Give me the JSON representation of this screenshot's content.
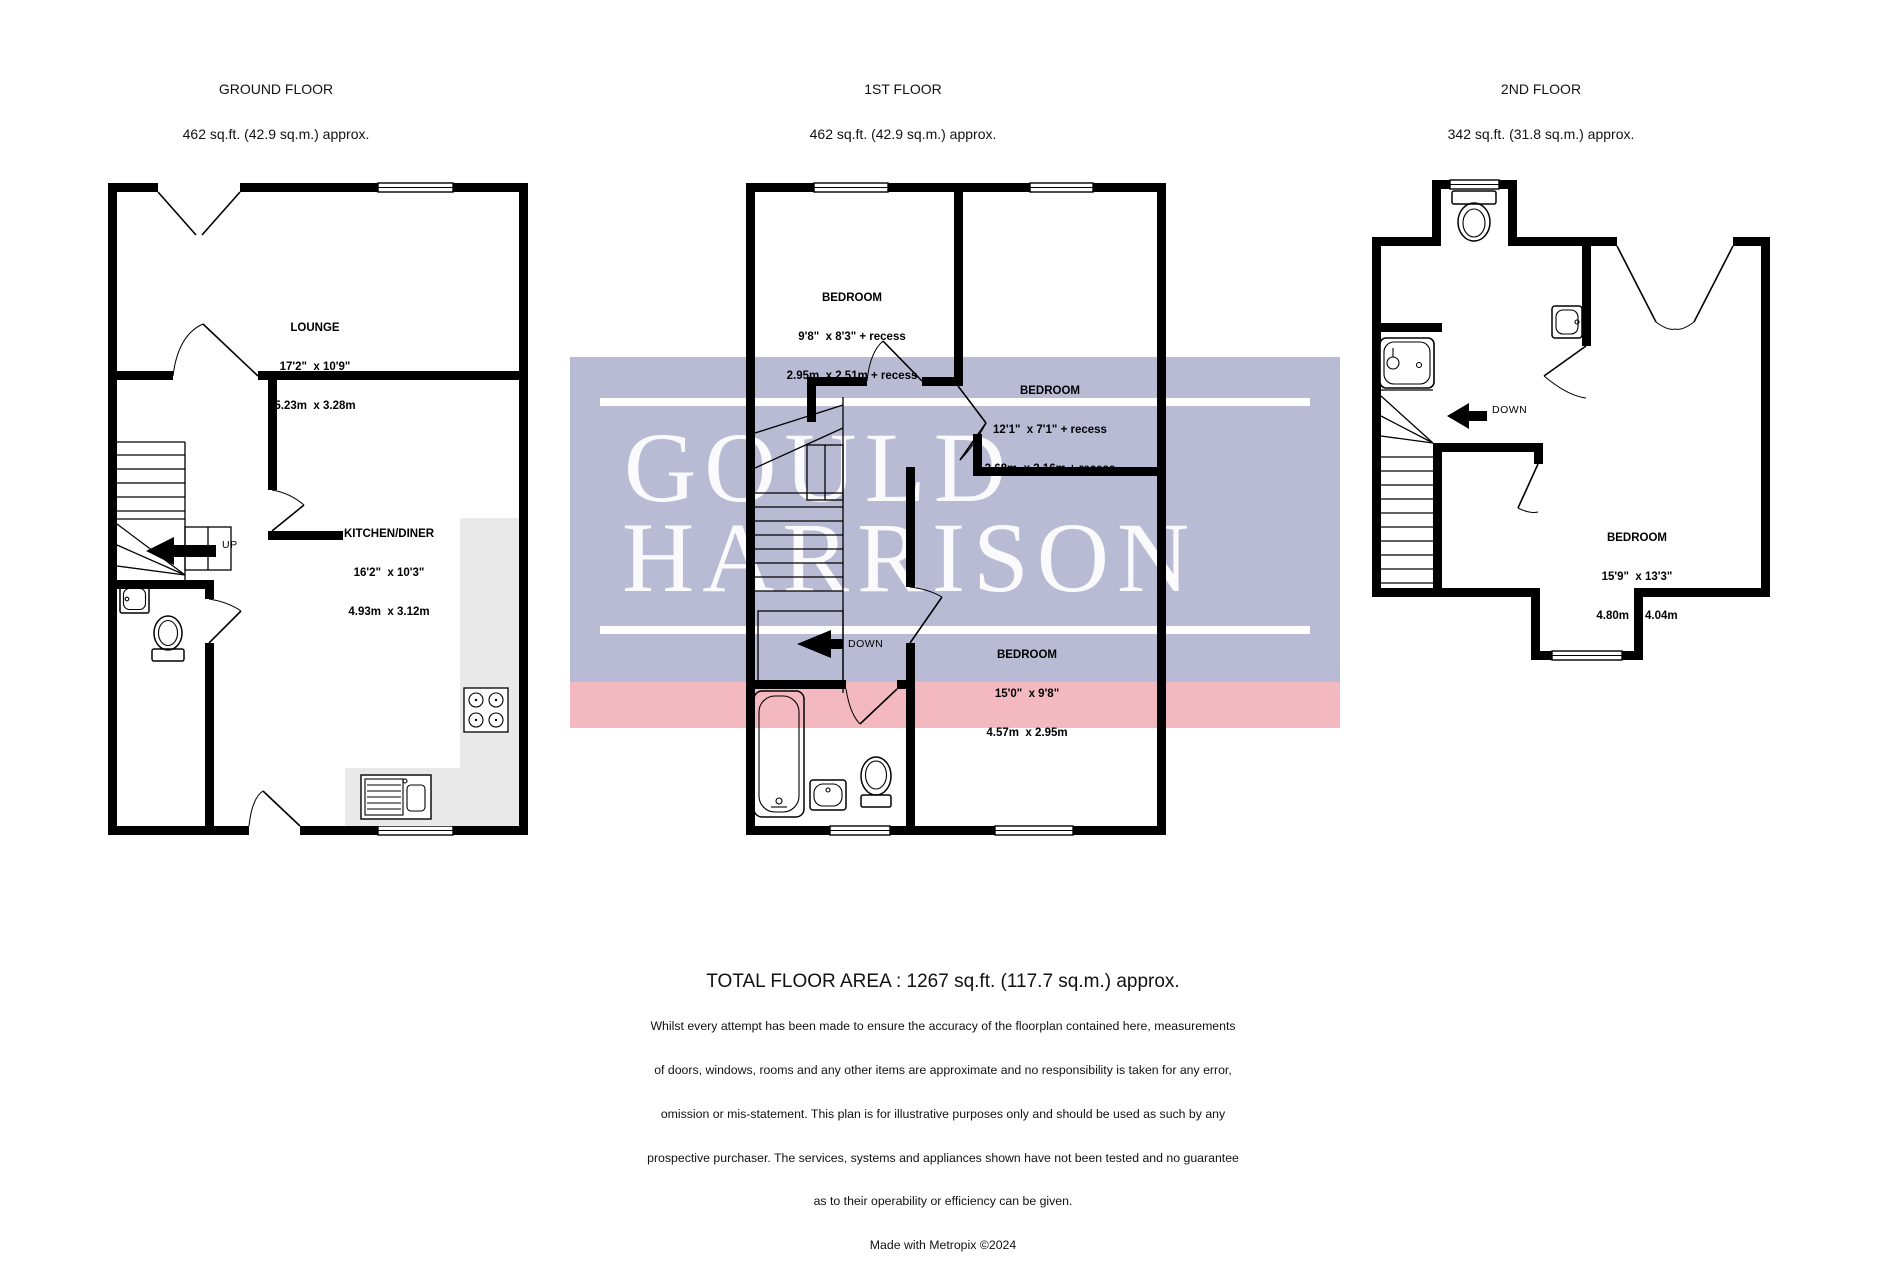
{
  "floors": [
    {
      "name": "GROUND FLOOR",
      "area": "462 sq.ft. (42.9 sq.m.) approx.",
      "rooms": [
        {
          "name": "LOUNGE",
          "imperial": "17'2\"  x 10'9\"",
          "metric": "5.23m  x 3.28m"
        },
        {
          "name": "KITCHEN/DINER",
          "imperial": "16'2\"  x 10'3\"",
          "metric": "4.93m  x 3.12m"
        }
      ],
      "stair": "UP"
    },
    {
      "name": "1ST FLOOR",
      "area": "462 sq.ft. (42.9 sq.m.) approx.",
      "rooms": [
        {
          "name": "BEDROOM",
          "imperial": "9'8\"  x 8'3\" + recess",
          "metric": "2.95m  x 2.51m + recess"
        },
        {
          "name": "BEDROOM",
          "imperial": "12'1\"  x 7'1\" + recess",
          "metric": "3.68m  x 2.16m + recess"
        },
        {
          "name": "BEDROOM",
          "imperial": "15'0\"  x 9'8\"",
          "metric": "4.57m  x 2.95m"
        }
      ],
      "stair": "DOWN"
    },
    {
      "name": "2ND FLOOR",
      "area": "342 sq.ft. (31.8 sq.m.) approx.",
      "rooms": [
        {
          "name": "BEDROOM",
          "imperial": "15'9\"  x 13'3\"",
          "metric": "4.80m  x 4.04m"
        }
      ],
      "stair": "DOWN"
    }
  ],
  "watermark": {
    "line1": "GOULD",
    "line2": "HARRISON",
    "band_color": "#b9bbd5",
    "accent_color": "#f4b9c0"
  },
  "footer": {
    "total": "TOTAL FLOOR AREA : 1267 sq.ft. (117.7 sq.m.) approx.",
    "disclaimer": [
      "Whilst every attempt has been made to ensure the accuracy of the floorplan contained here, measurements",
      "of doors, windows, rooms and any other items are approximate and no responsibility is taken for any error,",
      "omission or mis-statement. This plan is for illustrative purposes only and should be used as such by any",
      "prospective purchaser. The services, systems and appliances shown have not been tested and no guarantee",
      "as to their operability or efficiency can be given."
    ],
    "credit": "Made with Metropix ©2024"
  },
  "colors": {
    "wall": "#000000",
    "counter": "#e9e9e9"
  }
}
